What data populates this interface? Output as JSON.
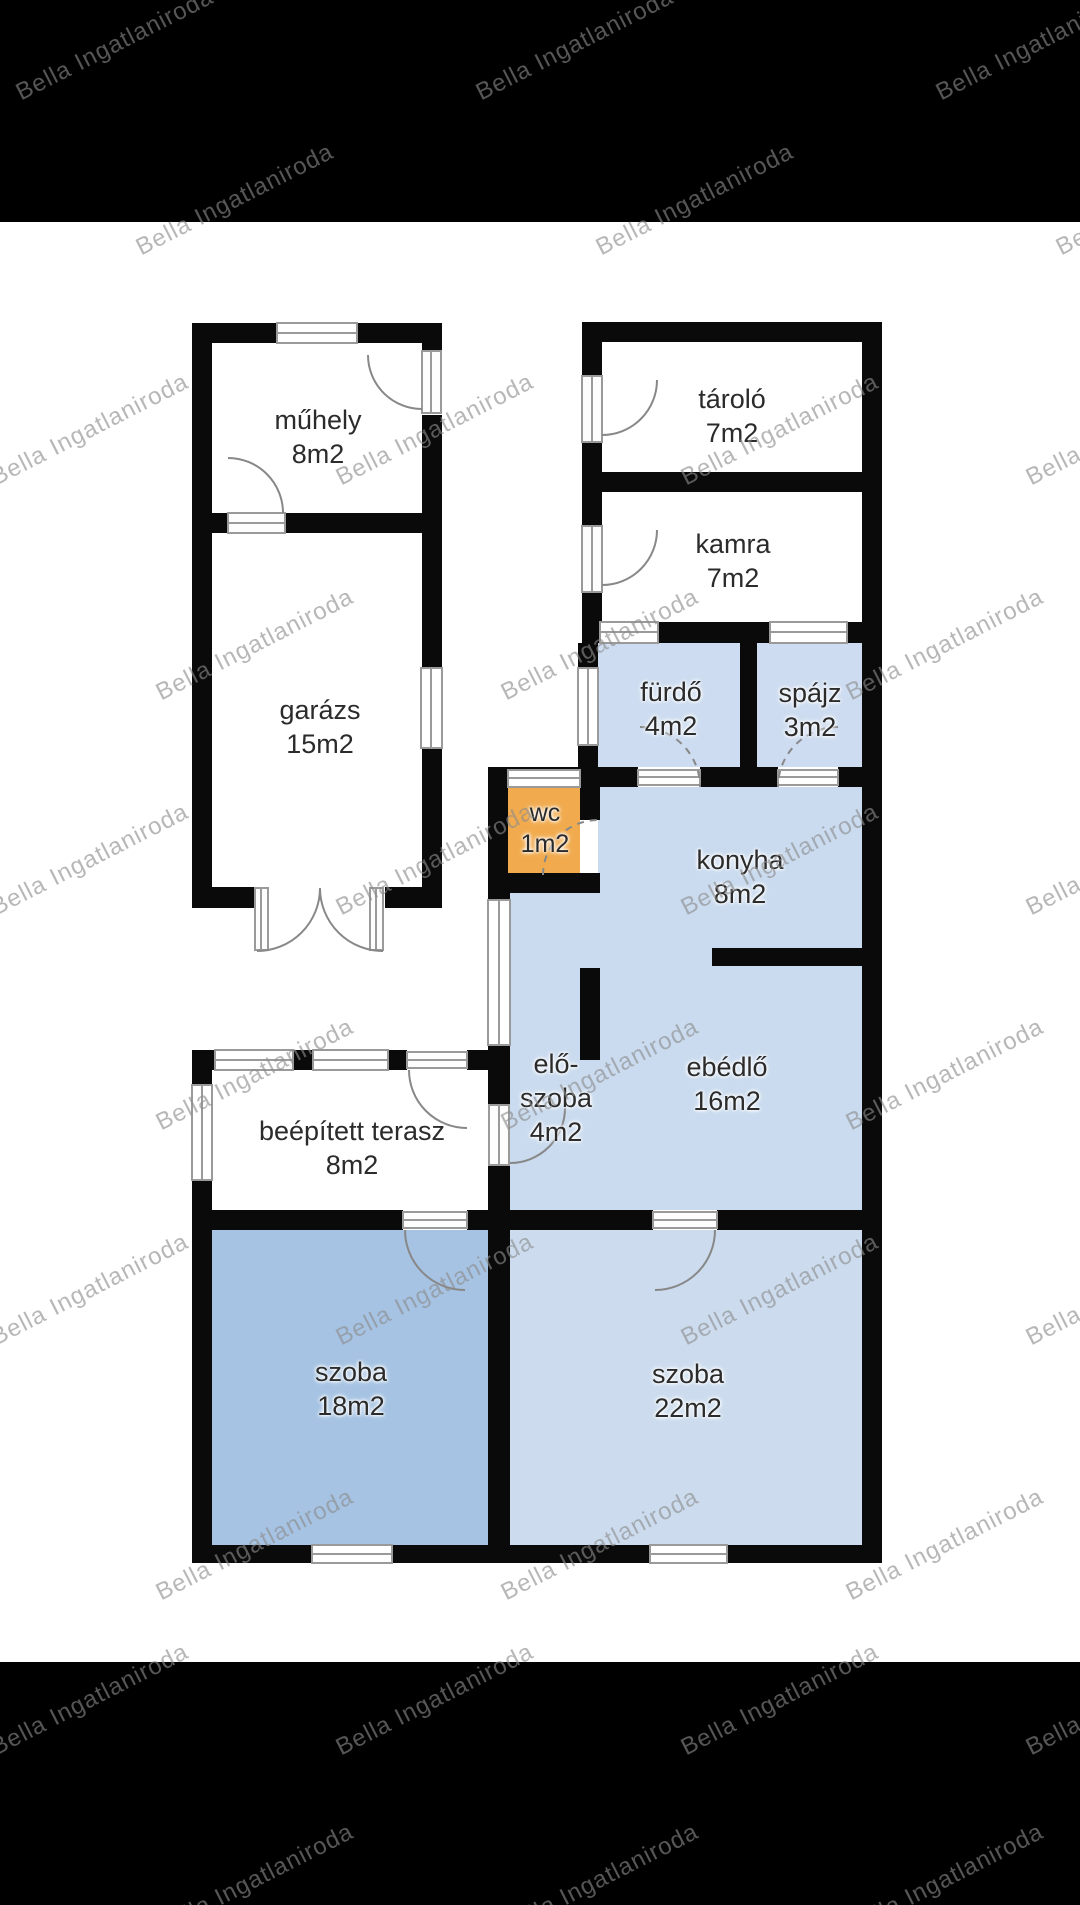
{
  "watermark": {
    "text": "Bella Ingatlaniroda",
    "color": "#8c8c8c"
  },
  "floorplan": {
    "wall_color": "#0a0a0a",
    "rooms": {
      "muhely": {
        "name": "műhely",
        "area": "8m2",
        "fill": "#ffffff"
      },
      "tarolo": {
        "name": "tároló",
        "area": "7m2",
        "fill": "#ffffff"
      },
      "kamra": {
        "name": "kamra",
        "area": "7m2",
        "fill": "#ffffff"
      },
      "garazs": {
        "name": "garázs",
        "area": "15m2",
        "fill": "#ffffff"
      },
      "furdo": {
        "name": "fürdő",
        "area": "4m2",
        "fill": "#cddcf0"
      },
      "spajz": {
        "name": "spájz",
        "area": "3m2",
        "fill": "#cddcf0"
      },
      "wc": {
        "name": "wc",
        "area": "1m2",
        "fill": "#f1ab4e"
      },
      "konyha": {
        "name": "konyha",
        "area": "8m2",
        "fill": "#cadbef"
      },
      "eloszoba": {
        "name_line1": "elő-",
        "name_line2": "szoba",
        "area": "4m2",
        "fill": "#cadbef"
      },
      "ebedlo": {
        "name": "ebédlő",
        "area": "16m2",
        "fill": "#cadbef"
      },
      "terasz": {
        "name": "beépített terasz",
        "area": "8m2",
        "fill": "#ffffff"
      },
      "szoba18": {
        "name": "szoba",
        "area": "18m2",
        "fill": "#a6c3e3"
      },
      "szoba22": {
        "name": "szoba",
        "area": "22m2",
        "fill": "#ccdcee"
      }
    }
  }
}
